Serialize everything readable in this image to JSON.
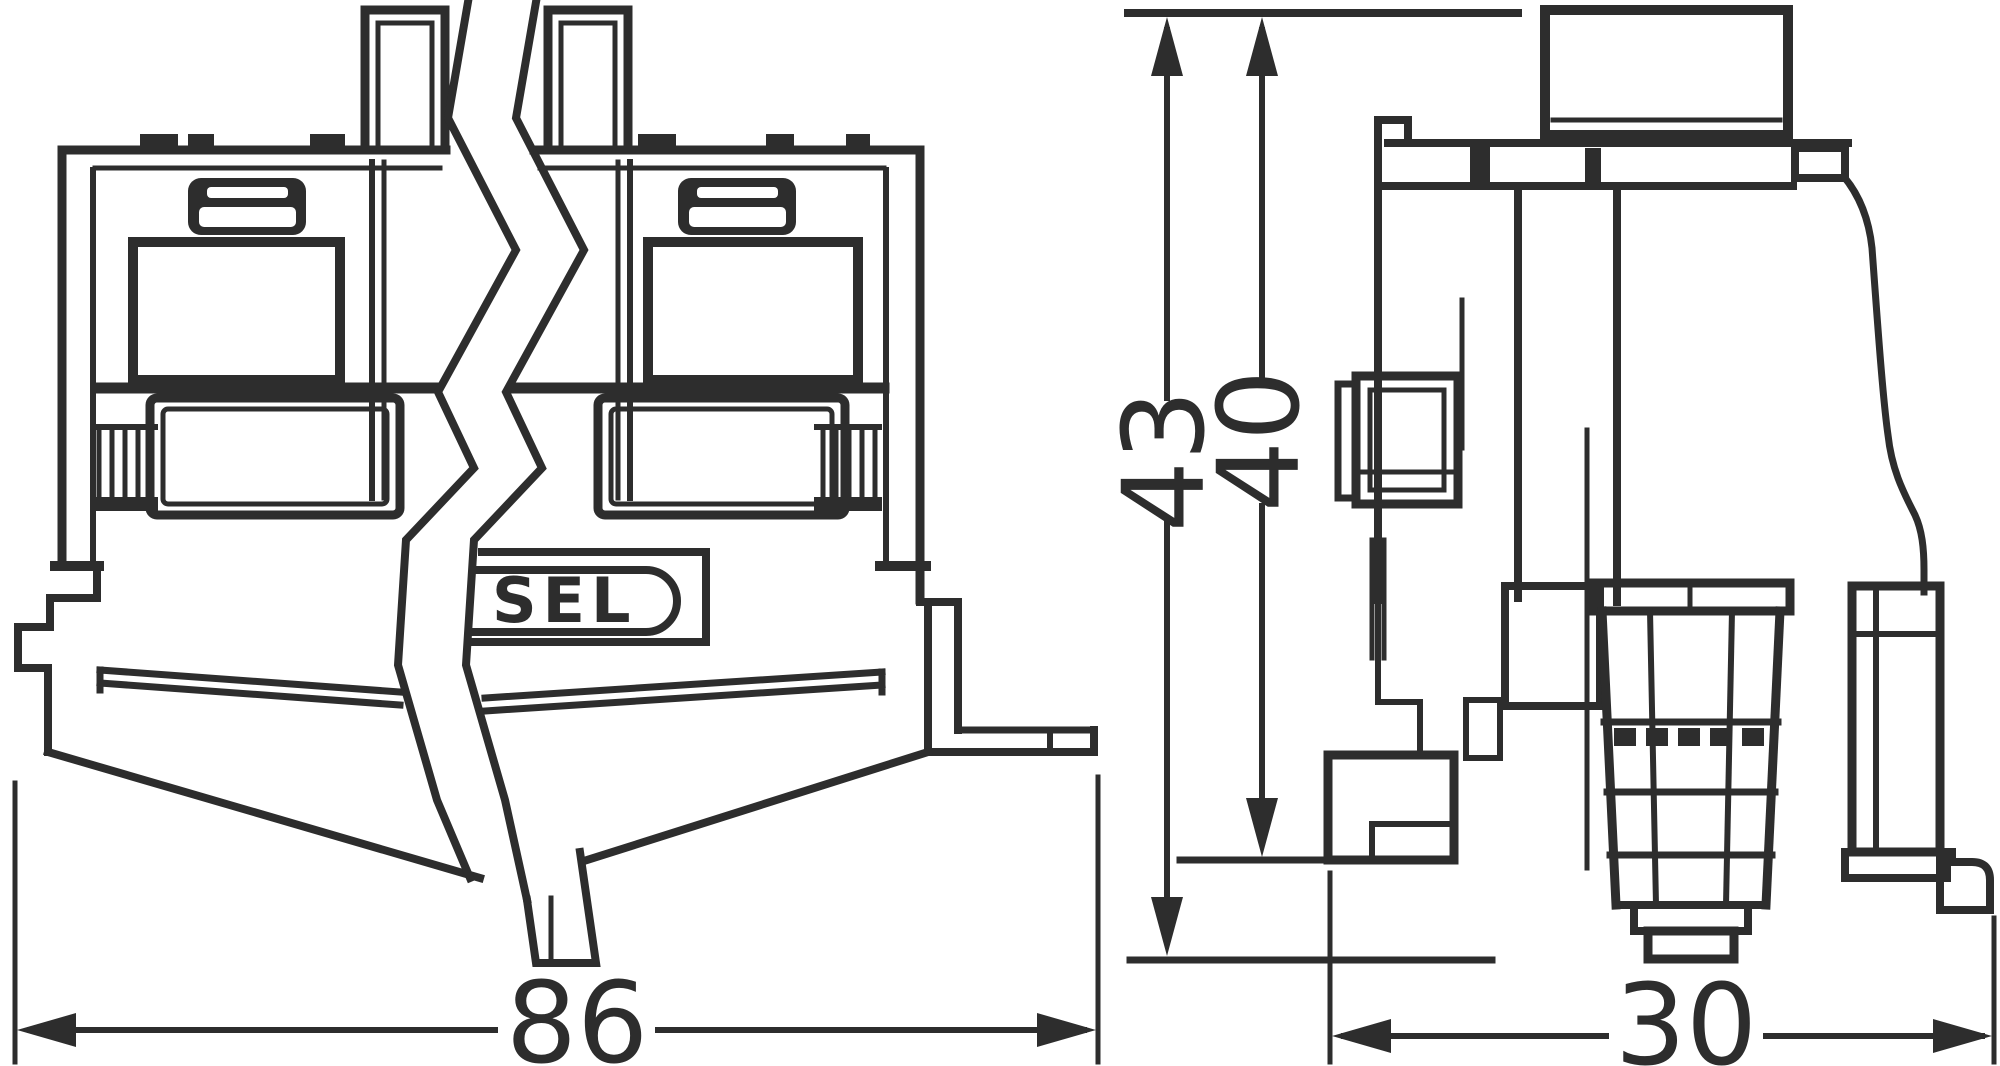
{
  "drawing": {
    "kind": "technical dimensional drawing, two views of a terminal block",
    "label": {
      "brand_fragment": "SEL"
    },
    "dimensions": {
      "total_width": "86",
      "total_height": "43",
      "body_height": "40",
      "depth": "30"
    },
    "colors": {
      "line": "#2d2d2d",
      "background": "#ffffff"
    }
  }
}
